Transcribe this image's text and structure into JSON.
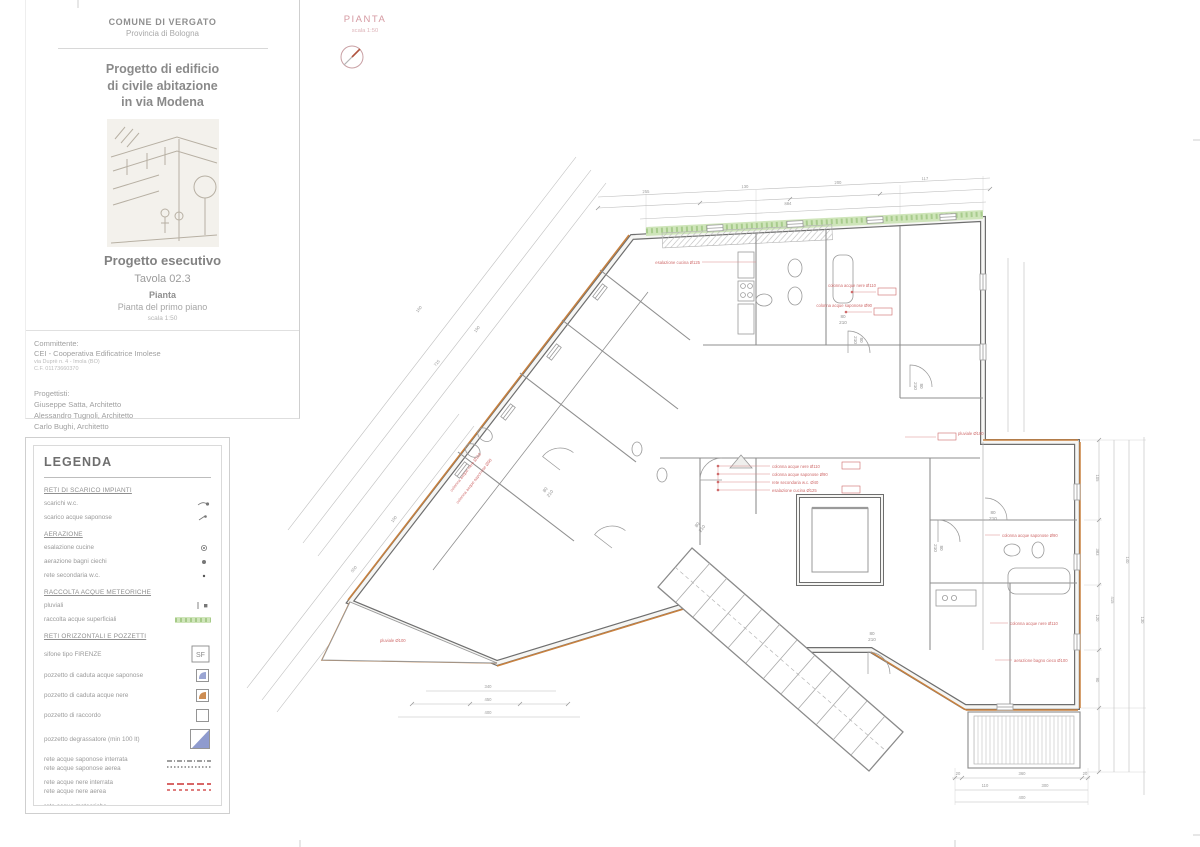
{
  "sheet": {
    "header": {
      "municipality": "COMUNE DI VERGATO",
      "province": "Provincia di Bologna"
    },
    "project_title_lines": [
      "Progetto di edificio",
      "di civile abitazione",
      "in via Modena"
    ],
    "phase": "Progetto esecutivo",
    "sheet_number": "Tavola 02.3",
    "drawing_type": "Pianta",
    "drawing_subtitle": "Pianta  del primo piano",
    "scale": "scala 1:50",
    "client": {
      "label": "Committente:",
      "name": "CEI - Cooperativa Edificatrice Imolese",
      "address": "via Duprè n. 4 - Imola (BO)",
      "tax_code": "C.F. 01173660370"
    },
    "designers": {
      "label": "Progettisti:",
      "names": [
        "Giuseppe Satta, Architetto",
        "Alessandro Tugnoli, Architetto",
        "Carlo Bughi, Architetto"
      ]
    }
  },
  "plan_header": {
    "title": "PIANTA",
    "scale": "scala 1:50"
  },
  "legend": {
    "title": "LEGENDA",
    "sf_label": "SF",
    "sections": [
      {
        "heading": "RETI DI SCARICO IMPIANTI",
        "items": [
          {
            "label": "scarichi w.c."
          },
          {
            "label": "scarico acque saponose"
          }
        ]
      },
      {
        "heading": "AERAZIONE",
        "items": [
          {
            "label": "esalazione cucine"
          },
          {
            "label": "aerazione bagni ciechi"
          },
          {
            "label": "rete secondaria w.c."
          }
        ]
      },
      {
        "heading": "RACCOLTA ACQUE METEORICHE",
        "items": [
          {
            "label": "pluviali"
          },
          {
            "label": "raccolta acque superficiali"
          }
        ]
      },
      {
        "heading": "RETI ORIZZONTALI E POZZETTI",
        "items": [
          {
            "label": "sifone tipo FIRENZE"
          },
          {
            "label": "pozzetto di caduta acque saponose"
          },
          {
            "label": "pozzetto di caduta acque nere"
          },
          {
            "label": "pozzetto di raccordo"
          },
          {
            "label": "pozzetto degrassatore (min 100 lt)"
          },
          {
            "label": "rete acque saponose interrata"
          },
          {
            "label": "rete acque saponose aerea"
          },
          {
            "label": "rete acque nere interrata"
          },
          {
            "label": "rete acque nere aerea"
          },
          {
            "label": "rete acque meteoriche"
          }
        ]
      }
    ]
  },
  "plan": {
    "door": {
      "width": "80",
      "height": "210"
    },
    "dims": [
      "255",
      "130",
      "200",
      "117",
      "884",
      "105",
      "383",
      "120",
      "90",
      "415",
      "140",
      "130",
      "340",
      "450",
      "400",
      "20",
      "360",
      "110",
      "300",
      "715",
      "190",
      "160",
      "550",
      "100",
      "400",
      "140",
      "90",
      "280",
      "110"
    ],
    "annotations": [
      "esalazione cucina Ø125",
      "colonna acque nere Ø110",
      "colonna acque saponose Ø90",
      "rete secondaria w.c. Ø40",
      "pluviale Ø100",
      "aerazione bagno cieco Ø100"
    ]
  },
  "colors": {
    "accent_orange": "#c8813f",
    "annotation_red": "#cf6b6b",
    "surface_green": "#cfe5ba",
    "legend_blue": "#8f9bce",
    "net_red": "#cc3333",
    "net_green": "#6fae52",
    "plan_title_pink": "#d59aa2",
    "wall_gray": "#6e6e6e"
  }
}
